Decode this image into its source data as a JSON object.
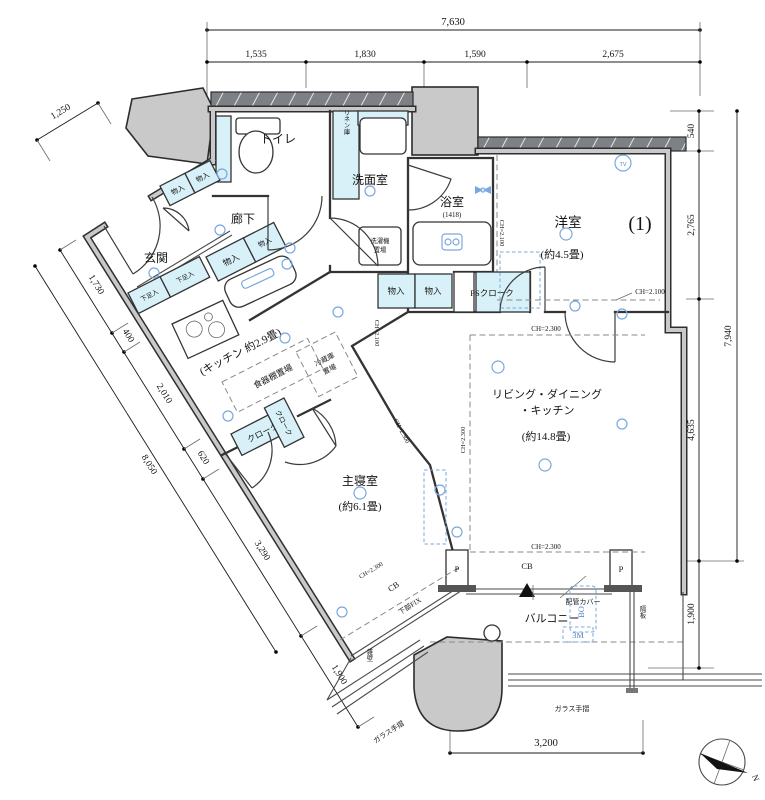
{
  "rooms": {
    "toilet": "トイレ",
    "linen": "リネン庫",
    "washroom": "洗面室",
    "bath": "浴室",
    "bath_size": "(1418)",
    "western_room": "洋室",
    "western_no": "(1)",
    "western_size": "(約4.5畳)",
    "hallway": "廊下",
    "entrance": "玄関",
    "kitchen": "(キッチン 約2.9畳)",
    "ldk_line1": "リビング・ダイニング",
    "ldk_line2": "・キッチン",
    "ldk_size": "(約14.8畳)",
    "bedroom": "主寝室",
    "bedroom_size": "(約6.1畳)",
    "balcony": "バルコニー"
  },
  "storage": {
    "closet": "物入",
    "shoe": "下足入",
    "cloak": "クローク",
    "ps_cloak": "PSクローク",
    "washer_1": "洗濯機",
    "washer_2": "置場",
    "dish_rack": "食器棚置場",
    "fridge_1": "冷蔵庫",
    "fridge_2": "置場"
  },
  "annotations": {
    "ch_2100": "CH=2.100",
    "ch_2300": "CH=2.300",
    "cb": "CB",
    "lower_fix": "下部FIX",
    "p": "P",
    "pipe_cover": "配管カバー",
    "bo": "BO",
    "three_m": "3M",
    "partition": "隔板",
    "stub_wall": "雑壁",
    "glass_rail": "ガラス手摺",
    "tv": "TV",
    "north": "N"
  },
  "dimensions": {
    "top_total": "7,630",
    "top": [
      "1,535",
      "1,830",
      "1,590",
      "2,675"
    ],
    "left_total": "8,050",
    "left": [
      "1,250",
      "1,730",
      "400",
      "2,010",
      "620",
      "3,290",
      "1,900"
    ],
    "right_total": "7,940",
    "right": [
      "540",
      "2,765",
      "4,635",
      "1,900"
    ],
    "bottom": "3,200"
  },
  "colors": {
    "wall": "#2f2f2f",
    "wall_core": "#c9c9c9",
    "fixture_fill": "#d8f1f8",
    "pillar_fill": "#c9c9c9",
    "symbol_blue": "#7aa7e0",
    "background": "#ffffff"
  }
}
